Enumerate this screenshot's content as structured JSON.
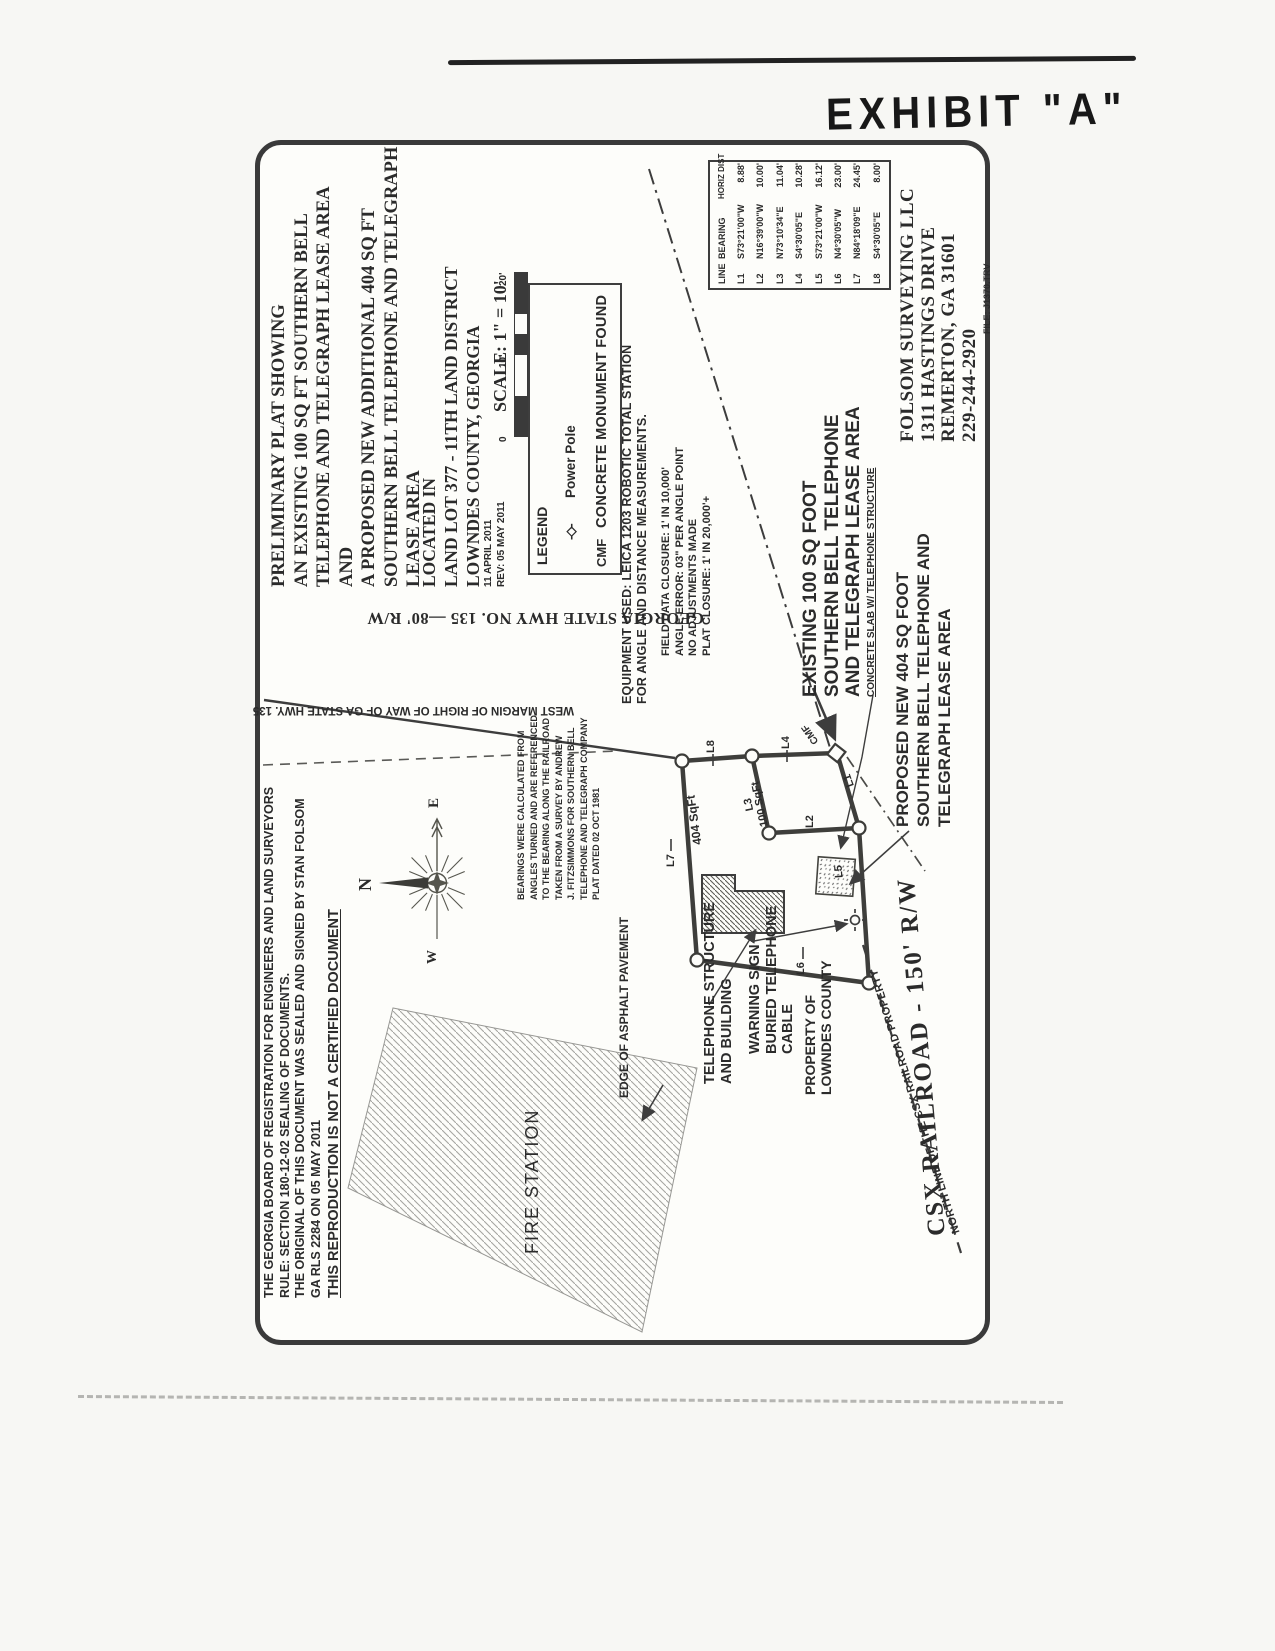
{
  "page": {
    "exhibit_label": "EXHIBIT \"A\""
  },
  "title_block": {
    "lines": [
      "PRELIMINARY PLAT SHOWING",
      "AN EXISTING 100 SQ FT SOUTHERN BELL",
      "TELEPHONE AND TELEGRAPH LEASE AREA",
      "AND",
      "A PROPOSED NEW ADDITIONAL 404 SQ FT",
      "SOUTHERN BELL TELEPHONE AND TELEGRAPH",
      "LEASE AREA"
    ]
  },
  "location_block": {
    "lines": [
      "LOCATED IN",
      "LAND LOT 377 - 11TH LAND DISTRICT",
      "LOWNDES COUNTY, GEORGIA"
    ]
  },
  "dates": {
    "created": "11 APRIL 2011",
    "revised": "REV: 05 MAY 2011"
  },
  "scale": {
    "label": "SCALE: 1\" = 10'",
    "ticks": [
      "0",
      "10'",
      "20'"
    ]
  },
  "legend": {
    "title": "LEGEND",
    "power_pole": {
      "symbol": "-◇-",
      "label": "Power Pole"
    },
    "cmf": {
      "symbol": "CMF",
      "label": "CONCRETE MONUMENT FOUND"
    }
  },
  "equipment_note": {
    "lines": [
      "EQUIPMENT USED: LEICA 1203 ROBOTIC TOTAL STATION",
      "FOR ANGLE AND DISTANCE MEASUREMENTS."
    ]
  },
  "closure_note": {
    "lines": [
      "FIELD DATA CLOSURE: 1' IN 10,000'",
      "ANGLE ERROR: 03\" PER ANGLE POINT",
      "NO ADJUSTMENTS MADE",
      "PLAT CLOSURE: 1' IN 20,000'+"
    ]
  },
  "line_table": {
    "headers": [
      "LINE",
      "BEARING",
      "HORIZ DIST"
    ],
    "rows": [
      [
        "L1",
        "S73°21'00\"W",
        "8.88'"
      ],
      [
        "L2",
        "N16°39'00\"W",
        "10.00'"
      ],
      [
        "L3",
        "N73°10'34\"E",
        "11.04'"
      ],
      [
        "L4",
        "S4°30'05\"E",
        "10.28'"
      ],
      [
        "L5",
        "S73°21'00\"W",
        "16.12'"
      ],
      [
        "L6",
        "N4°30'05\"W",
        "23.00'"
      ],
      [
        "L7",
        "N84°18'09\"E",
        "24.45'"
      ],
      [
        "L8",
        "S4°30'05\"E",
        "8.00'"
      ]
    ]
  },
  "surveyor": {
    "lines": [
      "FOLSOM SURVEYING LLC",
      "1311 HASTINGS DRIVE",
      "REMERTON, GA 31601",
      "229-244-2920"
    ],
    "file_ref": "FILE: J1370.TRV"
  },
  "board_note": {
    "lines": [
      "THE GEORGIA BOARD OF REGISTRATION FOR ENGINEERS AND LAND SURVEYORS",
      "RULE: SECTION 180-12-02 SEALING OF DOCUMENTS.",
      "THE ORIGINAL OF THIS DOCUMENT WAS SEALED AND SIGNED BY STAN FOLSOM",
      "GA RLS 2284 ON 05 MAY 2011"
    ],
    "warning": "THIS REPRODUCTION IS NOT A CERTIFIED DOCUMENT"
  },
  "bearings_note": {
    "lines": [
      "BEARINGS WERE CALCULATED FROM",
      "ANGLES TURNED AND ARE REFERENCED",
      "TO THE BEARING ALONG THE RAILROAD",
      "TAKEN FROM A SURVEY BY ANDREW",
      "J. FITZSIMMONS FOR SOUTHERN BELL",
      "TELEPHONE AND TELEGRAPH COMPANY",
      "PLAT DATED 02 OCT 1981"
    ]
  },
  "roads": {
    "highway": "GEORGIA STATE HWY NO. 135 —80' R/W",
    "west_margin": "WEST MARGIN OF RIGHT OF WAY OF GA STATE HWY. 135",
    "railroad": "CSX RAILROAD - 150' R/W",
    "railroad_north_line": "NORTH LINE OF THE CSX RAILROAD PROPERTY"
  },
  "site_labels": {
    "existing_area": [
      "EXISTING 100 SQ FOOT",
      "SOUTHERN BELL TELEPHONE",
      "AND TELEGRAPH LEASE AREA"
    ],
    "proposed_area": [
      "PROPOSED NEW 404 SQ FOOT",
      "SOUTHERN BELL TELEPHONE AND",
      "TELEGRAPH LEASE AREA"
    ],
    "concrete_slab": "CONCRETE SLAB W/ TELEPHONE STRUCTURE",
    "telephone_structure": [
      "TELEPHONE STRUCTURE",
      "AND BUILDING"
    ],
    "warning_sign": [
      "WARNING SIGN",
      "BURIED TELEPHONE",
      "CABLE"
    ],
    "property": [
      "PROPERTY OF",
      "LOWNDES COUNTY"
    ],
    "fire_station": "FIRE STATION",
    "edge_of_asphalt": "EDGE OF ASPHALT PAVEMENT",
    "area_404": "404 SqFt",
    "area_100": "100 SqFt",
    "cmf_point": "CMF"
  },
  "compass": {
    "north": "N",
    "east": "E",
    "west": "W"
  },
  "segments": {
    "labels": [
      "L1",
      "L2",
      "L3",
      "L4",
      "L5",
      "L6",
      "L7",
      "L8"
    ]
  }
}
